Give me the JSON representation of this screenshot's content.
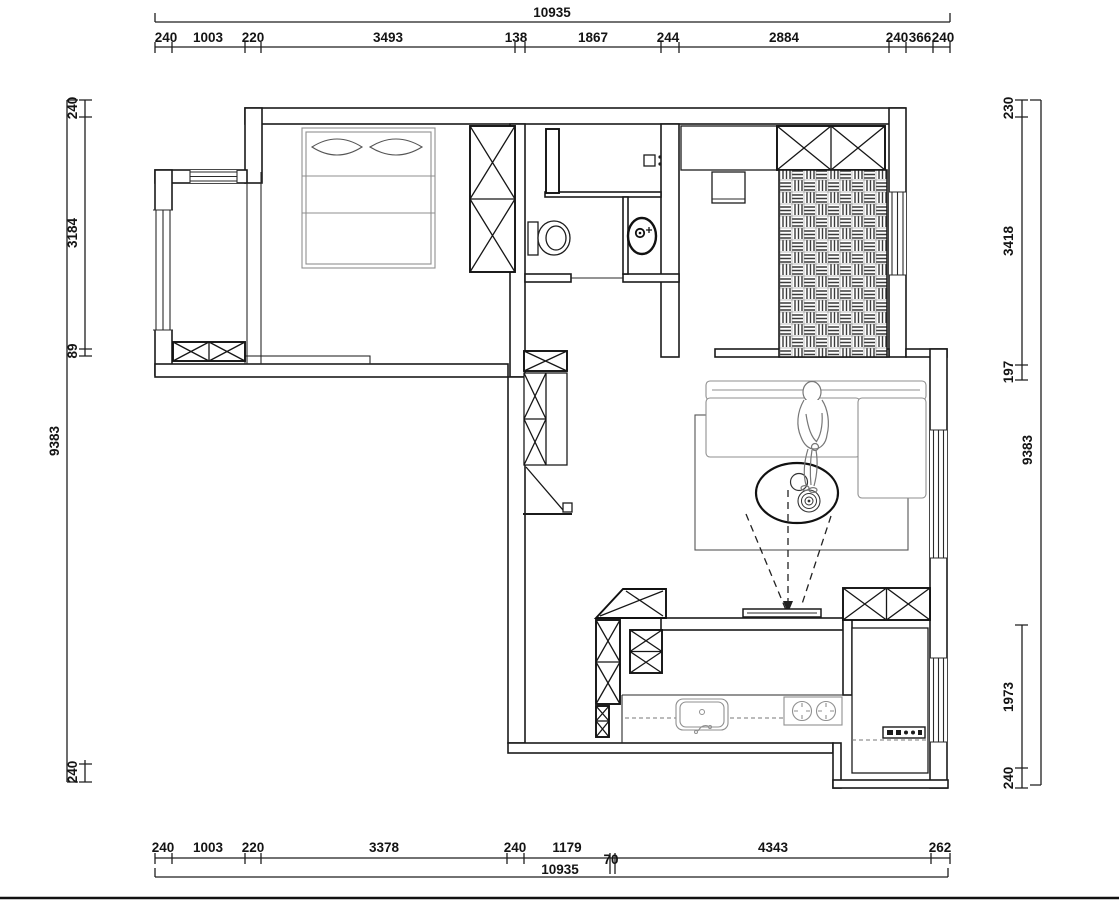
{
  "colors": {
    "line": "#1b1b1b",
    "background": "#ffffff",
    "furniture_light": "#8f8f8f"
  },
  "dimensions": {
    "top": {
      "total": "10935",
      "segments": [
        "240",
        "1003",
        "220",
        "3493",
        "138",
        "1867",
        "244",
        "2884",
        "240",
        "366",
        "240"
      ]
    },
    "bottom": {
      "total": "10935",
      "segments": [
        "240",
        "1003",
        "220",
        "3378",
        "240",
        "1179",
        "70",
        "4343",
        "262"
      ]
    },
    "left": {
      "outer_total": "9383",
      "segments": [
        "240",
        "3184",
        "89"
      ],
      "bottom_segment": "240"
    },
    "right": {
      "outer_total": "9383",
      "segments_top": [
        "230",
        "3418",
        "197"
      ],
      "segments_bottom": [
        "1973",
        "240"
      ]
    }
  }
}
